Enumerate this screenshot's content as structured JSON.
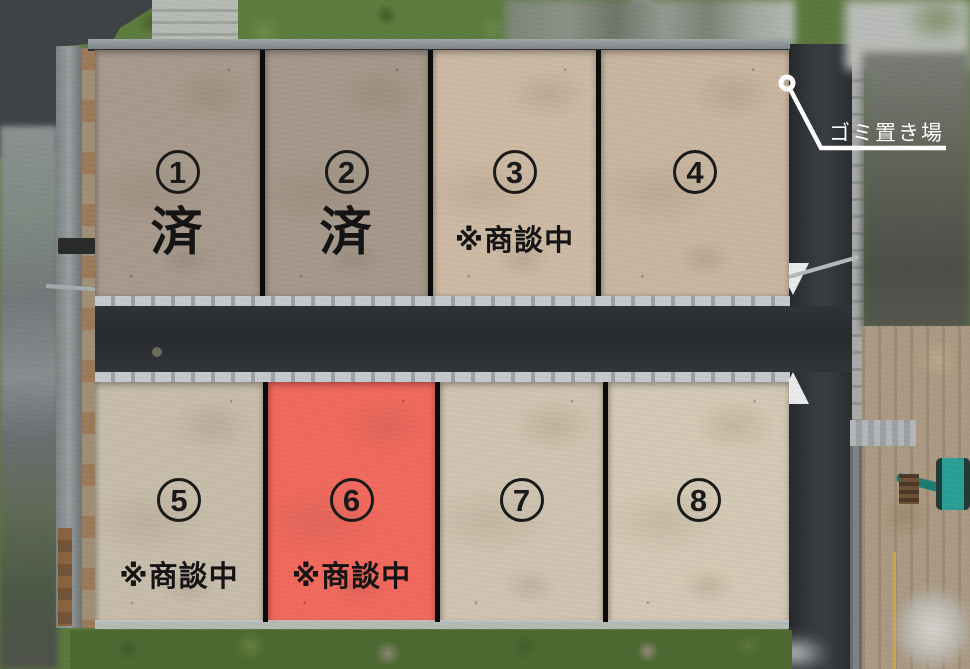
{
  "lots": [
    {
      "number": "1",
      "status": "済"
    },
    {
      "number": "2",
      "status": "済"
    },
    {
      "number": "3",
      "status": "※商談中"
    },
    {
      "number": "4",
      "status": ""
    },
    {
      "number": "5",
      "status": "※商談中"
    },
    {
      "number": "6",
      "status": "※商談中",
      "highlighted": true
    },
    {
      "number": "7",
      "status": ""
    },
    {
      "number": "8",
      "status": ""
    }
  ],
  "annotation": {
    "garbage_area_label": "ゴミ置き場"
  },
  "colors": {
    "highlight_lot": "#f2695e",
    "lot_label_text": "#1a1a1a",
    "annotation_text": "#ffffff",
    "road_asphalt": "#2e3134"
  }
}
